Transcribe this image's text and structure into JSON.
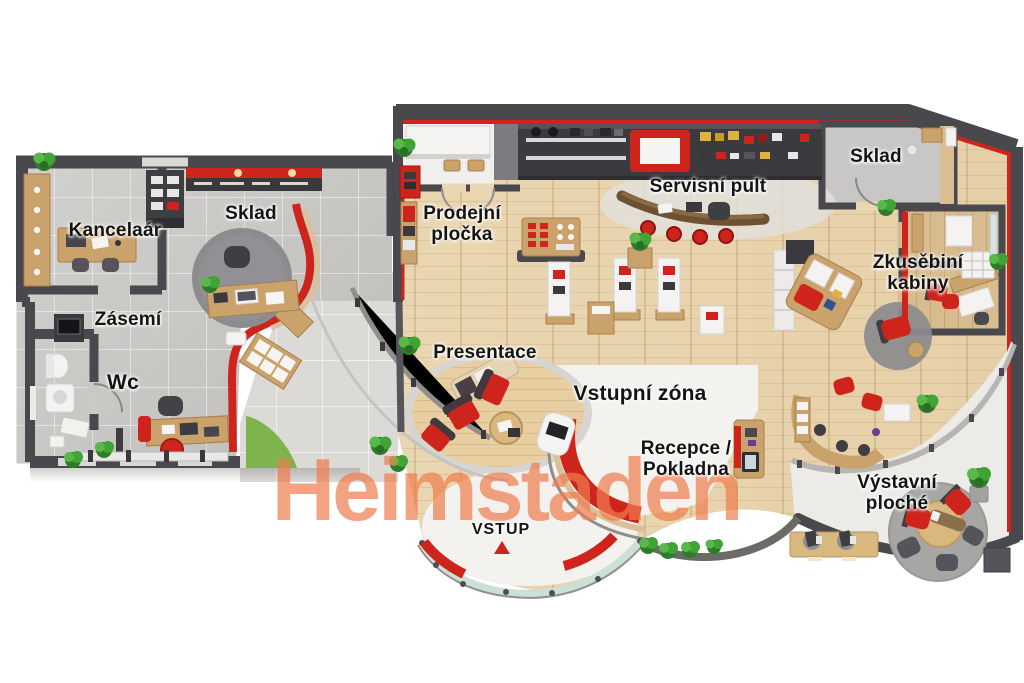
{
  "watermark": {
    "text": "Heimstaden",
    "color": "#EF7D4D"
  },
  "colors": {
    "accent_red": "#CE241C",
    "watermark_orange": "#EF7D4D",
    "wall_dark": "#49484C",
    "wood_floor": "#E9D6B2",
    "wood_furniture": "#C9A36B",
    "tile_floor": "#CBC9C6",
    "walkway_floor": "#DCDAD7",
    "storage_floor": "#C8C7C5",
    "grass_green": "#7FB34D",
    "plant_green": "#3E9637",
    "glass_green": "#CBE0D6",
    "white_zone": "#F3F2EF"
  },
  "left_building": {
    "name": "back-office-unit",
    "rooms": {
      "kancelar": {
        "label": "Kancelaár"
      },
      "sklad": {
        "label": "Sklad"
      },
      "zasemi": {
        "label": "Zásemí"
      },
      "wc": {
        "label": "Wc"
      }
    }
  },
  "right_building": {
    "name": "showroom-unit",
    "areas": {
      "prodejni_plocha": {
        "label": "Prodejní pločka"
      },
      "servisni_pult": {
        "label": "Servisní pult"
      },
      "sklad": {
        "label": "Sklad"
      },
      "zkusebni_kabiny": {
        "label": "Zkusěbiní kabiny"
      },
      "presentace": {
        "label": "Presentace"
      },
      "vstupni_zona": {
        "label": "Vstupní zóna"
      },
      "recepce_pokladna": {
        "label": "Recepce / Pokladna"
      },
      "vystavni_plochy": {
        "label": "Výstavní ploché"
      },
      "vstup": {
        "label": "VSTUP"
      }
    }
  }
}
